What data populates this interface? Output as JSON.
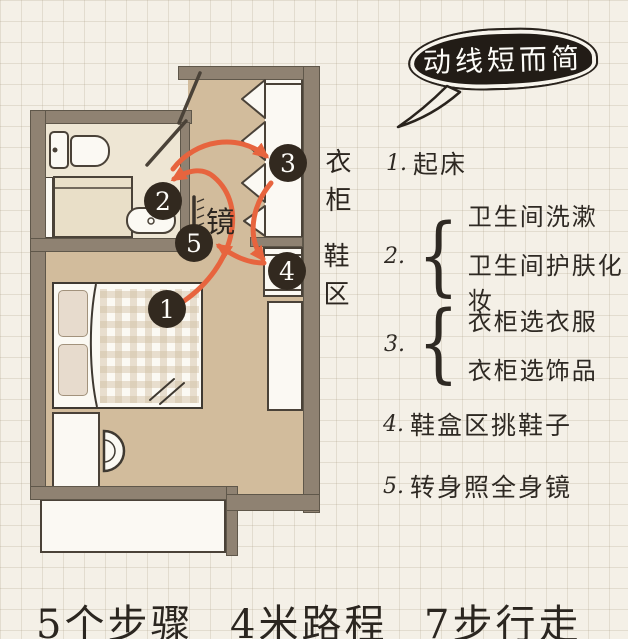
{
  "bubble": {
    "text": "动线短而简"
  },
  "plan": {
    "badges": [
      {
        "label": "1"
      },
      {
        "label": "2"
      },
      {
        "label": "3"
      },
      {
        "label": "4"
      },
      {
        "label": "5"
      }
    ],
    "labels": {
      "mirror": "镜",
      "wardrobe": "衣柜",
      "shoe_area": "鞋区"
    }
  },
  "route_list": {
    "brace": "{",
    "items": [
      {
        "num": "1.",
        "text": "起床"
      },
      {
        "num": "2.",
        "lines": [
          "卫生间洗漱",
          "卫生间护肤化妆"
        ]
      },
      {
        "num": "3.",
        "lines": [
          "衣柜选衣服",
          "衣柜选饰品"
        ]
      },
      {
        "num": "4.",
        "text": "鞋盒区挑鞋子"
      },
      {
        "num": "5.",
        "text": "转身照全身镜"
      }
    ]
  },
  "footer": {
    "stats": [
      "5个步骤",
      "4米路程",
      "7步行走"
    ]
  },
  "colors": {
    "arrow": "#e7643e",
    "wall": "#8f8272",
    "floor": "#d2bc9c",
    "bathroom_floor": "#eee6d4",
    "badge": "#32291f",
    "paper": "#f4f0e7"
  }
}
